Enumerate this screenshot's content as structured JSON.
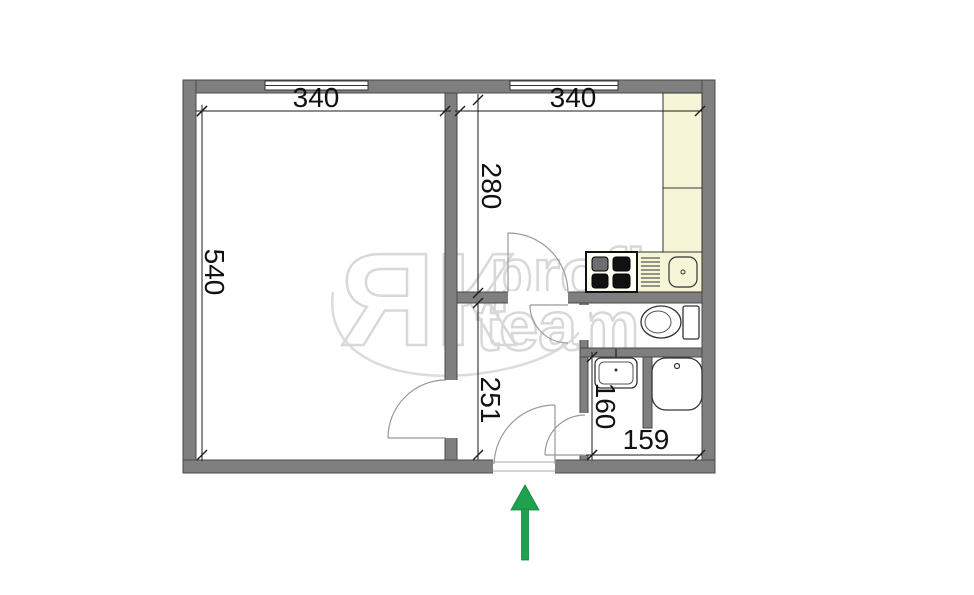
{
  "plan": {
    "dimensions": {
      "living_room_width": "340",
      "kitchen_width": "340",
      "kitchen_depth": "280",
      "living_room_depth": "540",
      "hallway_depth": "251",
      "bathroom_depth": "160",
      "bathroom_width": "159"
    },
    "watermark": {
      "brand": "ЯК",
      "word_top": "profi",
      "word_bottom": "team"
    },
    "colors": {
      "wall": "#7f7f7f",
      "counter": "#f7f5d8",
      "watermark": "#d8d8d8",
      "arrow_green": "#1fa24c",
      "dimension_text": "#111111"
    },
    "fixtures": [
      "kitchen-counter",
      "stove",
      "kitchen-sink",
      "toilet",
      "washbasin",
      "shower-tray"
    ],
    "entrance": {
      "arrow_direction": "up"
    }
  }
}
